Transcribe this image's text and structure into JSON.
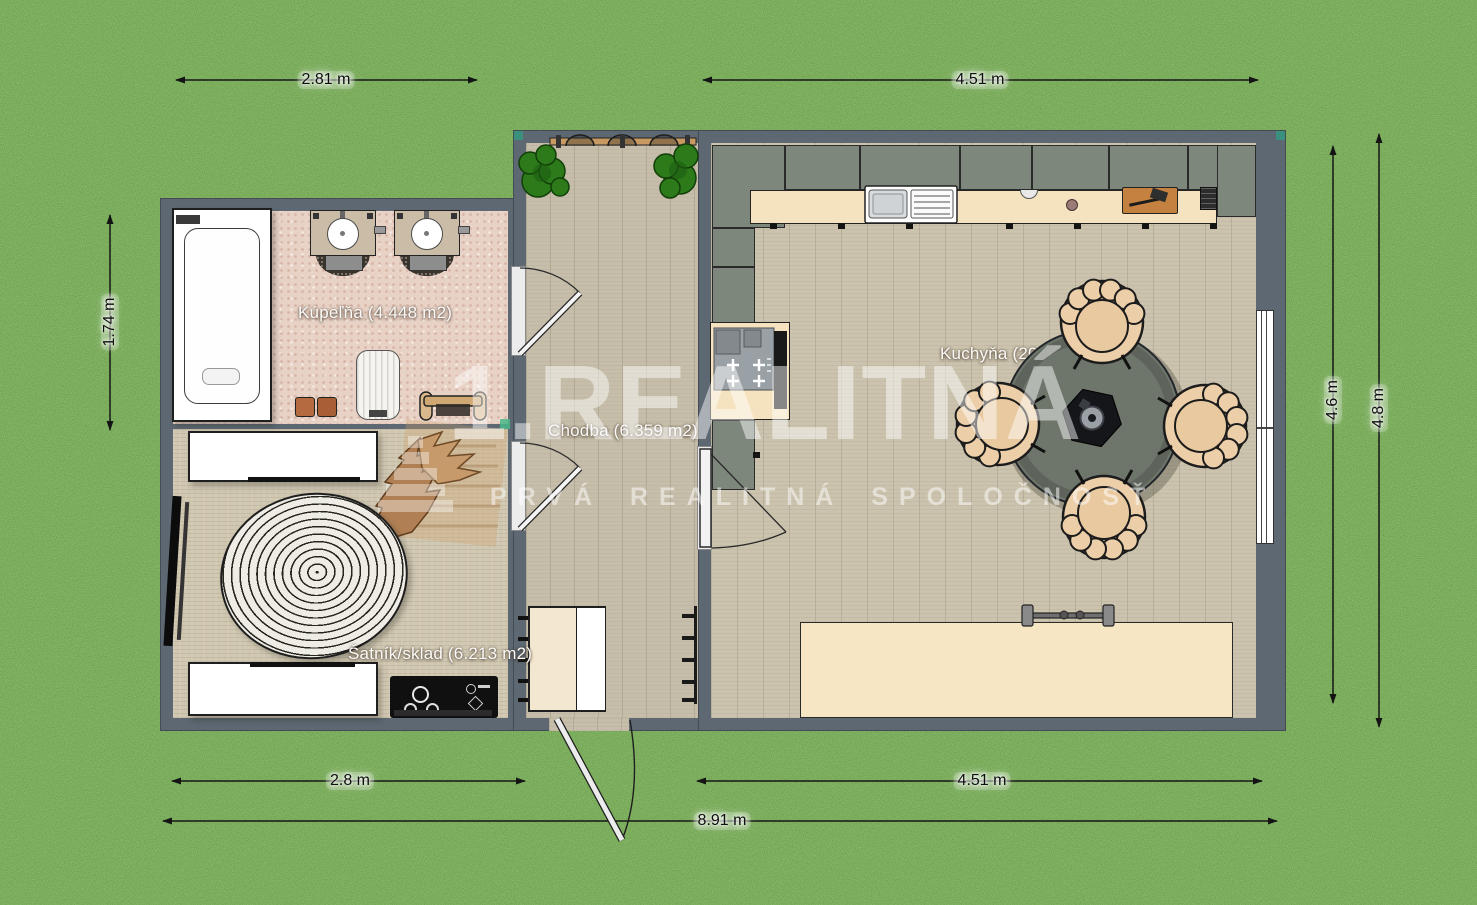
{
  "floorplan": {
    "watermark": {
      "brand": "1.REALITNÁ",
      "tagline": "PRVÁ REALITNÁ SPOLOČNOSŤ"
    },
    "rooms": {
      "bathroom": {
        "label": "Kúpeľňa (4.448 m2)"
      },
      "hallway": {
        "label": "Chodba (6.359 m2)"
      },
      "storage": {
        "label": "Šatník/sklad (6.213 m2)"
      },
      "kitchen": {
        "label": "Kuchyňa (20"
      }
    },
    "dimensions": {
      "top_left": "2.81 m",
      "top_right": "4.51 m",
      "left": "1.74 m",
      "right_inner": "4.6 m",
      "right_outer": "4.8 m",
      "bottom_left": "2.8 m",
      "bottom_right": "4.51 m",
      "bottom_total": "8.91 m"
    },
    "colors": {
      "grass": "#4a7a33",
      "wall": "#5d6872",
      "cabinet": "#7e877b",
      "counter": "#f5e3c0",
      "bathroom_floor": "#e8d2c6",
      "wood_floor": "#cbc3ae",
      "table": "#6e756a",
      "chair": "#eccfa8",
      "accent_teal": "#3a8f7d"
    }
  }
}
